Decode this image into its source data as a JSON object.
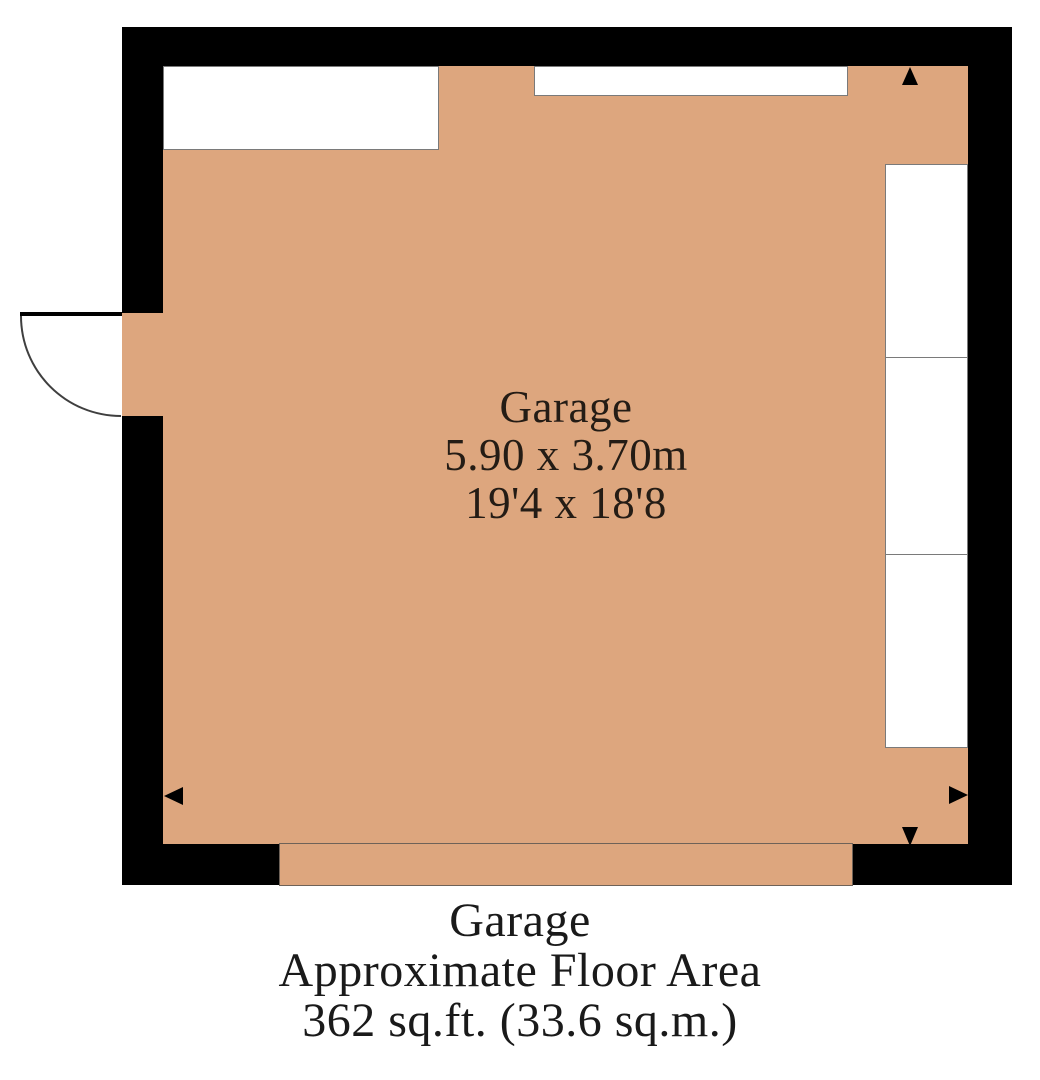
{
  "room_label": {
    "name": "Garage",
    "metric": "5.90 x 3.70m",
    "imperial": "19'4 x 18'8"
  },
  "caption": {
    "title": "Garage",
    "subtitle": "Approximate Floor Area",
    "area": "362 sq.ft. (33.6 sq.m.)"
  },
  "colors": {
    "wall": "#000000",
    "floor": "#DDA67E",
    "outline": "#6e6258",
    "recess_border": "#7a7a7a",
    "label_text": "#241c15",
    "caption_text": "#1a1a1a",
    "background": "#ffffff"
  }
}
